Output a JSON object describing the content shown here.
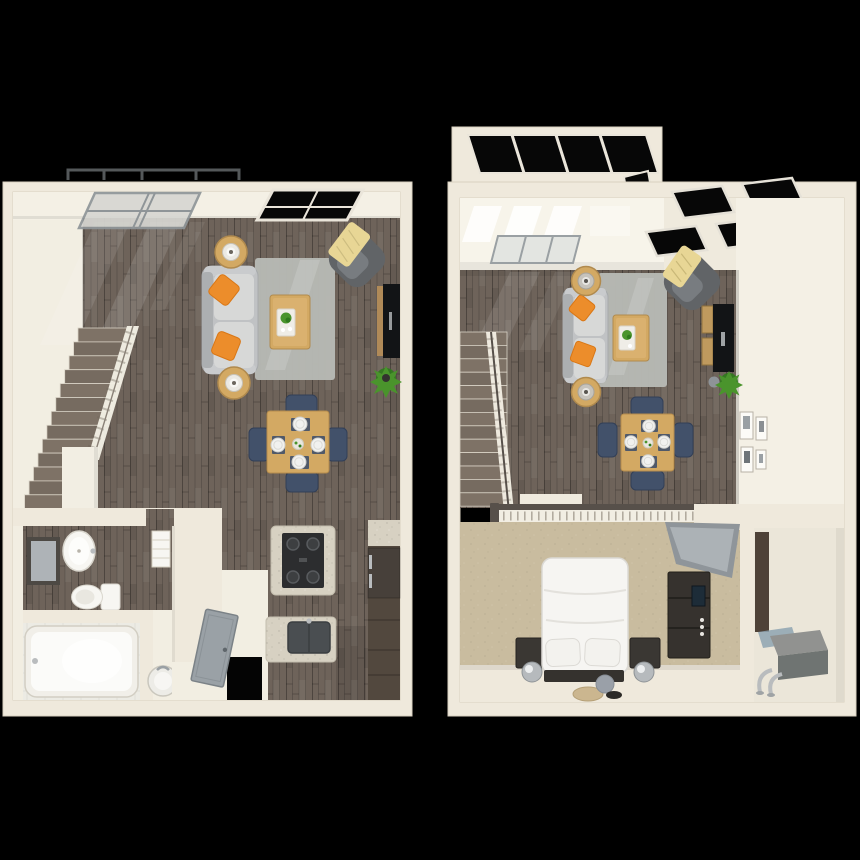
{
  "scene": {
    "type": "3d-floorplan-top-down-rendering",
    "background": "#000000",
    "plan_count": 2
  },
  "palette": {
    "background": "#000000",
    "wall": "#efe9dc",
    "wall_face": "#f4f0e5",
    "floor_light": "#f2eee2",
    "wood_floor": "#6e635a",
    "stair_wood": "#7e7266",
    "carpet": "#c9bc9f",
    "tile": "#ecebe4",
    "rug_gray": "#b7b9b4",
    "sofa_gray": "#c0c2c4",
    "sofa_back": "#acafb1",
    "sofa_cushion": "#d7d8d7",
    "accent_orange": "#ec8d2b",
    "armchair_gray": "#616467",
    "armchair_seat": "#787c80",
    "throw_yellow": "#e8d695",
    "table_wood": "#d3a963",
    "table_wood_light": "#e0b878",
    "chair_navy": "#42516a",
    "plate_white": "#f1f1ef",
    "tv_black": "#121416",
    "console_dark": "#3b3733",
    "cabinet_wood": "#52483e",
    "granite": "#d7d1c2",
    "stove_black": "#2c2d2f",
    "plant_green": "#4a942c",
    "plant_dark": "#2f7a1c",
    "porcelain": "#f7f6f2",
    "glass_dark": "#070707",
    "glass_light": "#d7d7d2",
    "frame_white": "#eae5da",
    "frame_gray": "#8f9598",
    "door_gray": "#9aa1a6",
    "railing_white": "#f2eee3",
    "railing_cap": "#57504a",
    "mirror_gray": "#aeb3b7",
    "metal_silver": "#b9bcbe",
    "nightstand_dark": "#3a3733",
    "bed_white": "#f6f5f2",
    "hvac_gray": "#919290",
    "closet_brown": "#4e4238",
    "pouf_tan": "#cbb68f",
    "pouf_gray": "#9aa0a8",
    "mat_blue": "#8ea3b0",
    "bay_frame": "#54585a"
  },
  "plans": [
    {
      "id": "lower-level-floorplan",
      "position": "left",
      "flooring": [
        "dark-wood-plank",
        "light-hall-floor",
        "white-tile-bath"
      ],
      "structure": [
        "perimeter-walls",
        "diagonal-staircase",
        "stair-railing",
        "guard-wall",
        "bay-window-frame",
        "light-glass-window",
        "dark-glass-window",
        "entry-doorway-opening"
      ],
      "rooms": [
        {
          "name": "living-room",
          "items": [
            {
              "item": "sofa",
              "count": 1
            },
            {
              "item": "accent-pillow",
              "count": 2
            },
            {
              "item": "round-side-table",
              "count": 2
            },
            {
              "item": "table-lamp",
              "count": 2
            },
            {
              "item": "area-rug",
              "count": 1
            },
            {
              "item": "coffee-table",
              "count": 1
            },
            {
              "item": "serving-tray-with-plant",
              "count": 1
            },
            {
              "item": "armchair",
              "count": 1
            },
            {
              "item": "throw-blanket",
              "count": 1
            },
            {
              "item": "flat-screen-tv",
              "count": 1
            },
            {
              "item": "media-shelf",
              "count": 1
            },
            {
              "item": "floor-plant",
              "count": 1
            }
          ]
        },
        {
          "name": "dining-area",
          "items": [
            {
              "item": "dining-table",
              "count": 1
            },
            {
              "item": "dining-chair",
              "count": 4
            },
            {
              "item": "placemat",
              "count": 4
            },
            {
              "item": "place-setting",
              "count": 4
            },
            {
              "item": "centerpiece",
              "count": 1
            }
          ]
        },
        {
          "name": "kitchen",
          "items": [
            {
              "item": "gas-range",
              "count": 1
            },
            {
              "item": "granite-counter",
              "count": 1
            },
            {
              "item": "peninsula-counter-with-sink",
              "count": 1
            },
            {
              "item": "refrigerator",
              "count": 1
            },
            {
              "item": "base-cabinets",
              "count": 1
            }
          ]
        },
        {
          "name": "bathroom",
          "items": [
            {
              "item": "wall-mirror",
              "count": 1
            },
            {
              "item": "pedestal-sink",
              "count": 1
            },
            {
              "item": "toilet",
              "count": 1
            },
            {
              "item": "bathtub",
              "count": 1
            },
            {
              "item": "towel-shelf",
              "count": 1
            },
            {
              "item": "water-heater",
              "count": 1
            }
          ]
        },
        {
          "name": "entry",
          "items": [
            {
              "item": "entry-door",
              "count": 1
            }
          ]
        }
      ]
    },
    {
      "id": "upper-level-loft-floorplan",
      "position": "right",
      "flooring": [
        "dark-wood-plank",
        "tan-carpet"
      ],
      "structure": [
        "perimeter-walls",
        "staircase",
        "stair-railing",
        "loft-railing",
        "skylight-bay",
        "ceiling-skylight-panes",
        "clerestory-window",
        "utility-closet",
        "picture-frames"
      ],
      "rooms": [
        {
          "name": "living-area-open-below",
          "items": [
            {
              "item": "sofa",
              "count": 1
            },
            {
              "item": "accent-pillow",
              "count": 2
            },
            {
              "item": "round-side-table",
              "count": 2
            },
            {
              "item": "table-lamp",
              "count": 2
            },
            {
              "item": "area-rug",
              "count": 1
            },
            {
              "item": "coffee-table",
              "count": 1
            },
            {
              "item": "armchair",
              "count": 1
            },
            {
              "item": "throw-blanket",
              "count": 1
            },
            {
              "item": "flat-screen-tv",
              "count": 1
            },
            {
              "item": "media-cubes",
              "count": 1
            },
            {
              "item": "floor-plant",
              "count": 1
            }
          ]
        },
        {
          "name": "dining-area-open-below",
          "items": [
            {
              "item": "dining-table",
              "count": 1
            },
            {
              "item": "dining-chair",
              "count": 4
            },
            {
              "item": "placemat",
              "count": 4
            },
            {
              "item": "place-setting",
              "count": 4
            },
            {
              "item": "centerpiece",
              "count": 1
            }
          ]
        },
        {
          "name": "loft-bedroom",
          "items": [
            {
              "item": "platform-bed",
              "count": 1
            },
            {
              "item": "bed-pillow",
              "count": 2
            },
            {
              "item": "nightstand",
              "count": 2
            },
            {
              "item": "sphere-lamp",
              "count": 2
            },
            {
              "item": "dresser",
              "count": 1
            },
            {
              "item": "leaning-floor-mirror",
              "count": 1
            },
            {
              "item": "round-pouf",
              "count": 2
            },
            {
              "item": "floor-tray",
              "count": 1
            }
          ]
        },
        {
          "name": "utility-closet",
          "items": [
            {
              "item": "hvac-unit",
              "count": 1
            },
            {
              "item": "water-pipes",
              "count": 1
            },
            {
              "item": "floor-mat",
              "count": 1
            }
          ]
        },
        {
          "name": "gallery-wall",
          "items": [
            {
              "item": "picture-frame",
              "count": 4
            }
          ]
        }
      ]
    }
  ]
}
